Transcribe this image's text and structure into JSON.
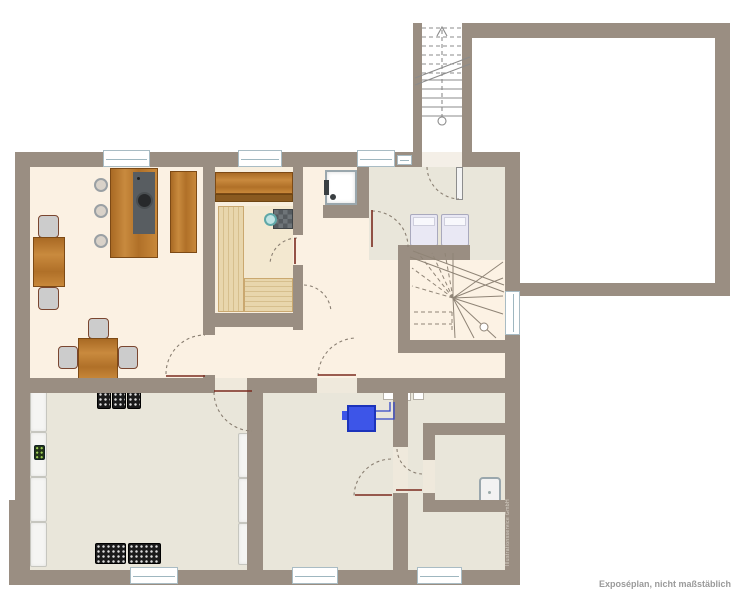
{
  "page": {
    "caption": "Exposéplan, nicht maßstäblich",
    "watermark": "Illustrationsservice GmbH"
  },
  "colors": {
    "wall": "#9a8e82",
    "floor_cream": "#fbf1e3",
    "floor_gray": "#e9e6da",
    "floor_stair": "#fcf2e4",
    "sauna_floor": "#f8eedd",
    "sauna_inner": "#f3e8d0",
    "parquet_a": "#e8d6ac",
    "parquet_b": "#d6bf8d",
    "wood_border": "#7d4a15",
    "counter": "#585d61",
    "sink": "#27292b",
    "chair": "#cccccc",
    "chair_border": "#7a4630",
    "boiler": "#3d55e8",
    "boiler_border": "#1c33bb",
    "pipe": "#3346c8",
    "appliance": "#e9e8f4",
    "appliance_border": "#a9a9bd",
    "teal": "#bfe3e3",
    "teal_border": "#5fa8a8",
    "crate": "#1b1b1b",
    "crate_dot": "#dcdcdc",
    "green_crate": "#223318",
    "green_dot": "#9ccf55",
    "shelf": "#f5f5f3",
    "shelf_border": "#c6c6bf",
    "window_border": "#a9bcc4",
    "window_line": "#9fb7c0",
    "stove_a": "#565b5f",
    "stove_b": "#6e7478",
    "door_leaf": "#7a2a1e",
    "arc": "#8a7f72",
    "stair_line": "#8b8b8b",
    "shower_border": "#9aa7ad",
    "fixture": "#3a3f42",
    "meter_border": "#b5b0a6",
    "threshold": "#efe9dc",
    "entrance_floor": "#f4efe7",
    "caption": "#9a9a9a",
    "watermark": "#d8d2c8"
  }
}
